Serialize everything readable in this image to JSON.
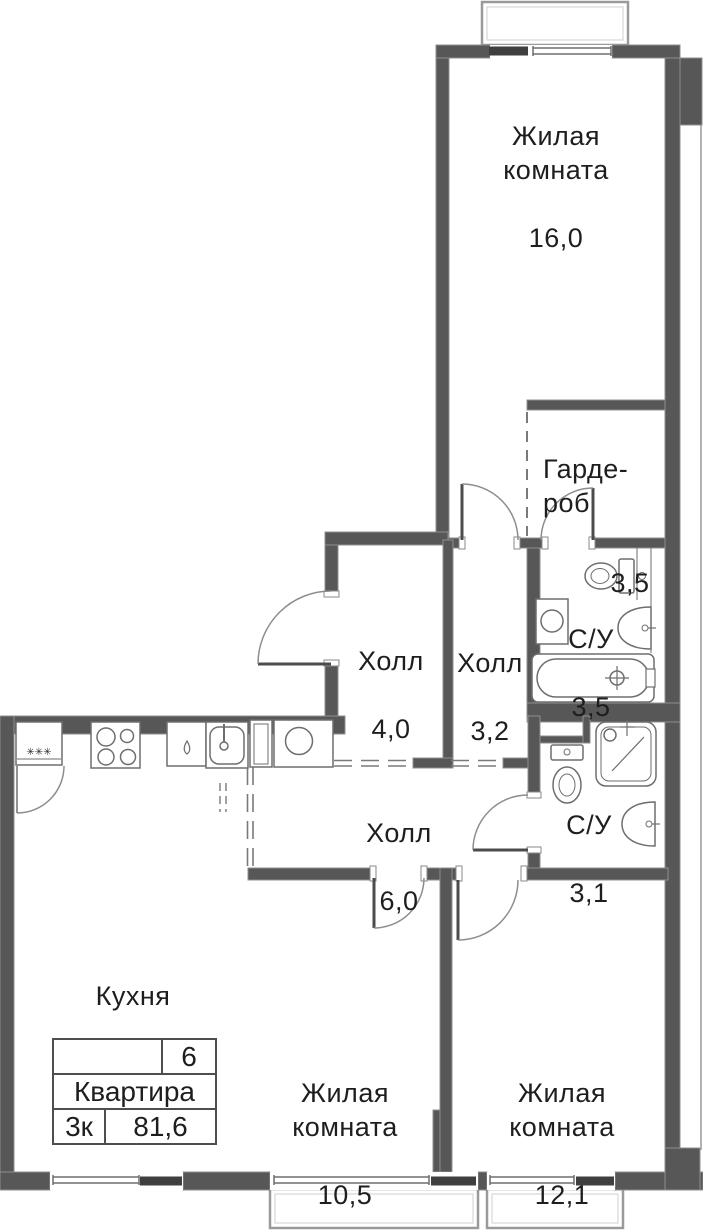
{
  "rooms": {
    "living1": {
      "name": "Жилая\nкомната",
      "area": "16,0"
    },
    "wardrobe": {
      "name": "Гарде-\nроб",
      "area": "3,5"
    },
    "bath1": {
      "name": "С/У",
      "area": "3,5"
    },
    "hall1": {
      "name": "Холл",
      "area": "4,0"
    },
    "hall2": {
      "name": "Холл",
      "area": "3,2"
    },
    "hall3": {
      "name": "Холл",
      "area": "6,0"
    },
    "bath2": {
      "name": "С/У",
      "area": "3,1"
    },
    "kitchen": {
      "name": "Кухня",
      "area": "19,7"
    },
    "living2": {
      "name": "Жилая\nкомната",
      "area": "10,5"
    },
    "living3": {
      "name": "Жилая\nкомната",
      "area": "12,1"
    }
  },
  "info_table": {
    "number": "6",
    "label": "Квартира",
    "rooms_count": "3к",
    "total_area": "81,6"
  },
  "symbols": {
    "freezer_stars": "✳✳✳"
  },
  "fixtures": [
    "fridge-icon",
    "stove-icon",
    "dishwasher-icon",
    "kitchen-sink-icon",
    "cabinet-icon",
    "washer-icon",
    "toilet-icon",
    "washing-machine-icon",
    "wall-sink-icon",
    "bathtub-icon",
    "shower-icon"
  ],
  "colors": {
    "wall": "#575757",
    "wall_edge": "#8f8f8f",
    "thin_line": "#9a9a9a",
    "fixture_line": "#6e6e6e",
    "text": "#1e1e1e",
    "background": "#ffffff"
  }
}
